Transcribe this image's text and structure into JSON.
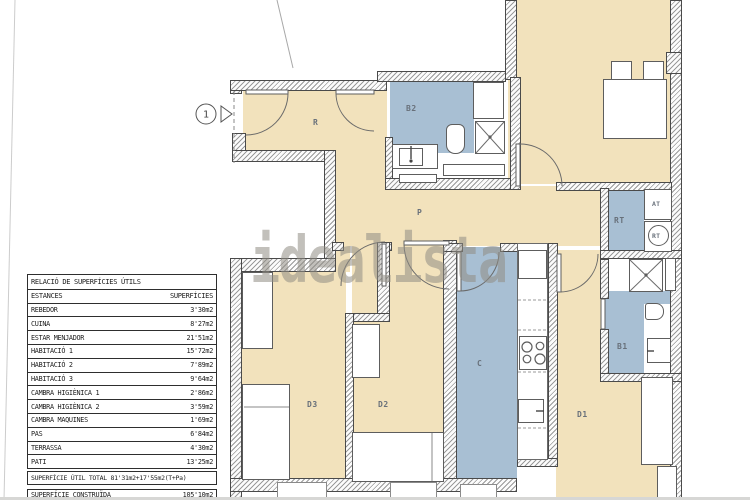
{
  "watermark": "idealista",
  "entry_marker": "1",
  "table": {
    "title": "RELACIÓ DE SUPERFÍCIES ÚTILS",
    "col_estances": "ESTANCES",
    "col_superficies": "SUPERFÍCIES",
    "rows": [
      {
        "name": "REBEDOR",
        "value": "3'30m2"
      },
      {
        "name": "CUINA",
        "value": "8'27m2"
      },
      {
        "name": "ESTAR MENJADOR",
        "value": "21'51m2"
      },
      {
        "name": "HABITACIÓ 1",
        "value": "15'72m2"
      },
      {
        "name": "HABITACIÓ 2",
        "value": "7'89m2"
      },
      {
        "name": "HABITACIÓ 3",
        "value": "9'64m2"
      },
      {
        "name": "CAMBRA HIGIÈNICA 1",
        "value": "2'86m2"
      },
      {
        "name": "CAMBRA HIGIÈNICA 2",
        "value": "3'59m2"
      },
      {
        "name": "CAMBRA MAQUINES",
        "value": "1'69m2"
      },
      {
        "name": "PAS",
        "value": "6'84m2"
      },
      {
        "name": "TERRASSA",
        "value": "4'30m2"
      },
      {
        "name": "PATI",
        "value": "13'25m2"
      }
    ],
    "total_line": "SUPERFÍCIE ÚTIL  TOTAL 81'31m2+17'55m2(T+Pa)",
    "built_label": "SUPERFÍCIE CONSTRUÏDA",
    "built_value": "105'10m2"
  },
  "plan": {
    "labels": {
      "entry_hall": "R",
      "hallway": "P",
      "bathroom2": "B2",
      "bathroom1": "B1",
      "kitchen": "C",
      "fridge": "F/M",
      "dishwasher": "RP",
      "bedroom1": "D1",
      "bedroom2": "D2",
      "bedroom3": "D3",
      "laundry": "RT",
      "at_unit": "AT",
      "rt_unit": "RT"
    },
    "colors": {
      "floor": "#f2e2bc",
      "wet": "#a8bfd3",
      "wall_line": "#4a4a4a",
      "label": "#68707a"
    }
  }
}
